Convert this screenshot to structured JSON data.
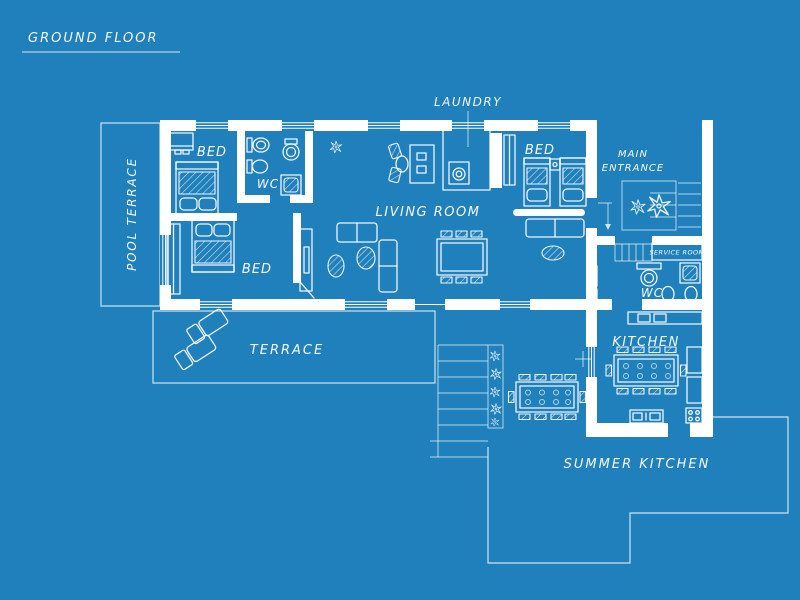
{
  "title": {
    "text": "GROUND FLOOR"
  },
  "labels": {
    "pool_terrace": "POOL TERRACE",
    "bed1": "BED",
    "bed2": "BED",
    "bed3": "BED",
    "wc1": "WC",
    "wc2": "WC",
    "living_room": "LIVING ROOM",
    "laundry": "LAUNDRY",
    "main_entrance_line1": "MAIN",
    "main_entrance_line2": "ENTRANCE",
    "service_room": "SERVICE ROOM",
    "kitchen": "KITCHEN",
    "terrace": "TERRACE",
    "summer_kitchen": "SUMMER KITCHEN"
  },
  "colors": {
    "background": "#2080BC",
    "wall": "#FFFFFF",
    "line": "#FFFFFF"
  }
}
